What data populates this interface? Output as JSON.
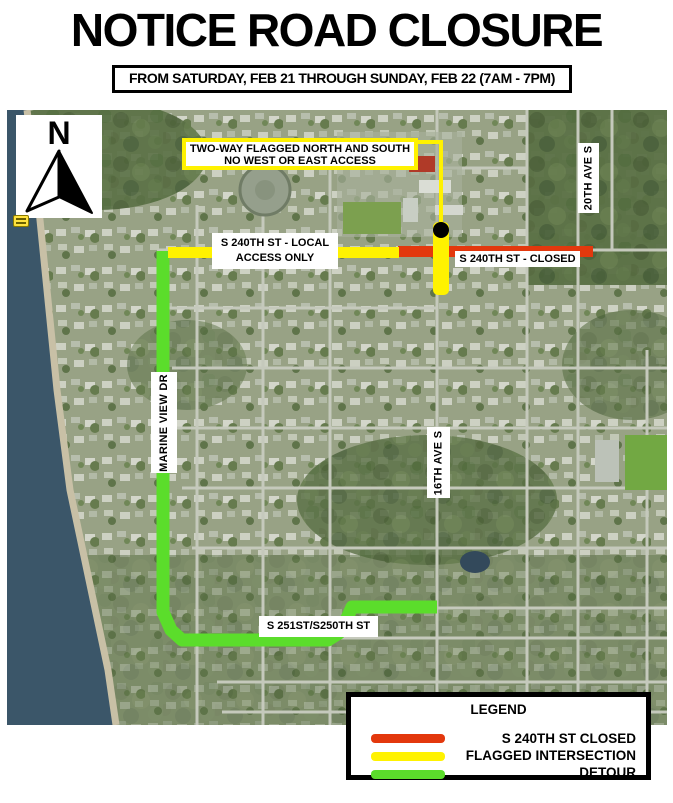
{
  "title": "NOTICE ROAD CLOSURE",
  "date_banner": "FROM SATURDAY, FEB 21 THROUGH SUNDAY, FEB 22 (7AM - 7PM)",
  "compass": {
    "north_label": "N"
  },
  "map": {
    "callout": {
      "line1": "TWO-WAY FLAGGED NORTH AND SOUTH",
      "line2": "NO WEST OR EAST ACCESS"
    },
    "street_labels": {
      "local_access_line1": "S 240TH ST - LOCAL",
      "local_access_line2": "ACCESS ONLY",
      "closed_segment": "S 240TH ST - CLOSED",
      "ave_20th": "20TH AVE S",
      "marine_view": "MARINE VIEW DR",
      "ave_16th": "16TH AVE S",
      "detour_streets": "S 251ST/S250TH ST"
    },
    "colors": {
      "closed": "#e3380d",
      "flagged": "#fff200",
      "detour": "#5bdd2b",
      "water": "#3b5669"
    }
  },
  "legend": {
    "title": "LEGEND",
    "items": [
      {
        "label": "S 240TH ST CLOSED",
        "color": "#e3380d"
      },
      {
        "label": "FLAGGED INTERSECTION",
        "color": "#fff200"
      },
      {
        "label": "DETOUR",
        "color": "#5bdd2b"
      }
    ]
  }
}
